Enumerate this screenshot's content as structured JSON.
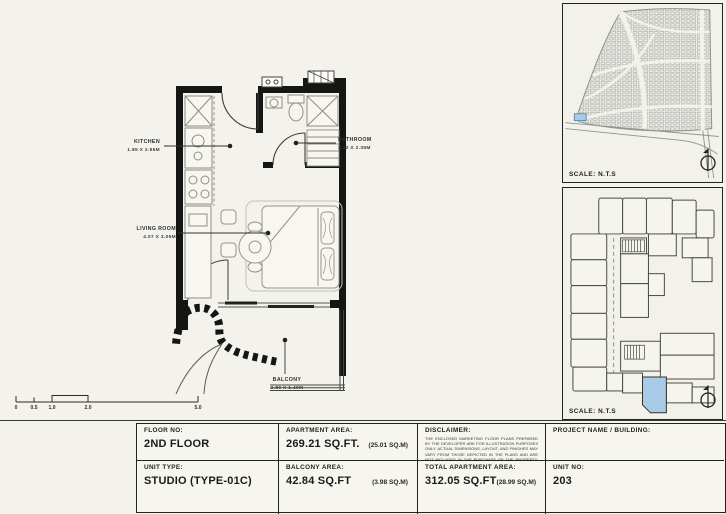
{
  "floor_plan": {
    "rooms": [
      {
        "name": "KITCHEN",
        "dims": "1.85 X 2.95M"
      },
      {
        "name": "BATHROOM",
        "dims": "2.12 X 2.35M"
      },
      {
        "name": "LIVING ROOM",
        "dims": "4.07 X 3.05M"
      },
      {
        "name": "BALCONY",
        "dims": "2.80 X 1.40M"
      }
    ]
  },
  "scale_bar": {
    "labels": [
      "0",
      "0.5",
      "1.0",
      "2.0",
      "5.0"
    ]
  },
  "panels": {
    "location_map": {
      "scale_label": "SCALE: N.T.S"
    },
    "key_plan": {
      "scale_label": "SCALE: N.T.S"
    }
  },
  "title_block": {
    "floor_no_label": "FLOOR NO:",
    "floor_no": "2ND FLOOR",
    "apartment_area_label": "APARTMENT AREA:",
    "apartment_area": "269.21 SQ.FT.",
    "apartment_area_m": "(25.01 SQ.M)",
    "disclaimer_label": "DISCLAIMER:",
    "disclaimer_text": "THE ENCLOSED MARKETING FLOOR PLANS PREPARED BY THE DEVELOPER ARE FOR ILLUSTRATION PURPOSES ONLY. ACTUAL DIMENSIONS, LAYOUT, AND FINISHES MAY VARY FROM THOSE DEPICTED IN THE PLANS AND ARE NOT INCLUDED IN THE PURCHASE OF THE PROPERTY. THE DEVELOPER RESERVES THE RIGHT TO MAKE MODIFICATIONS, REVISIONS, AND CHANGES TO THE FLOOR PLANS, SPECIFICATIONS, AND FEATURES WITHOUT PRIOR NOTICE.",
    "project_label": "PROJECT NAME / BUILDING:",
    "unit_type_label": "UNIT TYPE:",
    "unit_type": "STUDIO (TYPE-01C)",
    "balcony_area_label": "BALCONY AREA:",
    "balcony_area": "42.84 SQ.FT",
    "balcony_area_m": "(3.98 SQ.M)",
    "total_area_label": "TOTAL APARTMENT AREA:",
    "total_area": "312.05 SQ.FT",
    "total_area_m": "(28.99 SQ.M)",
    "unit_no_label": "UNIT NO:",
    "unit_no": "203"
  },
  "colors": {
    "highlight": "#a9cbe7",
    "wall": "#151513"
  }
}
